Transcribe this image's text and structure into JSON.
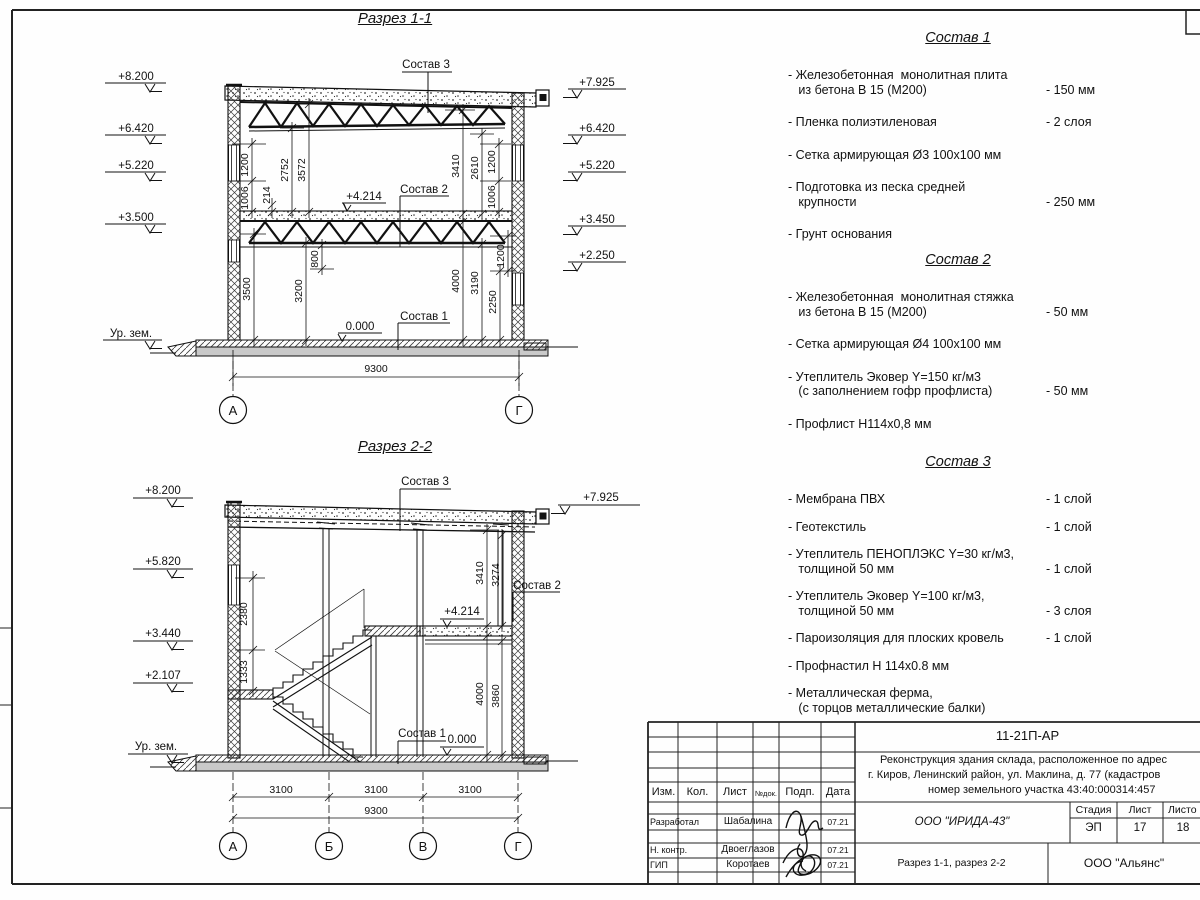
{
  "r1": {
    "title": "Разрез 1-1",
    "elev": {
      "l1": "+8.200",
      "l2": "+6.420",
      "l3": "+5.220",
      "l4": "+3.500",
      "ground": "Ур. зем.",
      "r1": "+7.925",
      "r2": "+6.420",
      "r3": "+5.220",
      "r4": "+3.450",
      "r5": "+2.250",
      "mid": "+4.214",
      "zero": "0.000"
    },
    "dims": {
      "d1200l": "1200",
      "d1006l": "1006",
      "d214": "214",
      "d2752": "2752",
      "d3572": "3572",
      "d3410": "3410",
      "d2610": "2610",
      "d1200r": "1200",
      "d1006r": "1006",
      "d3500": "3500",
      "d3200": "3200",
      "d800": "800",
      "d4000": "4000",
      "d3190": "3190",
      "d2250": "2250",
      "d1200r2": "1200",
      "span": "9300"
    },
    "labels": {
      "s1": "Состав 1",
      "s2": "Состав 2",
      "s3": "Состав 3"
    },
    "axes": {
      "a": "А",
      "g": "Г"
    }
  },
  "r2": {
    "title": "Разрез 2-2",
    "elev": {
      "l1": "+8.200",
      "l2": "+5.820",
      "l3": "+3.440",
      "l4": "+2.107",
      "ground": "Ур. зем.",
      "r1": "+7.925",
      "mid": "+4.214",
      "zero": "0.000"
    },
    "dims": {
      "d2380": "2380",
      "d1333": "1333",
      "d3410": "3410",
      "d3274": "3274",
      "d4000": "4000",
      "d3860": "3860",
      "s1": "3100",
      "s2": "3100",
      "s3": "3100",
      "span": "9300"
    },
    "labels": {
      "s1": "Состав 1",
      "s2": "Состав 2",
      "s3": "Состав 3"
    },
    "axes": {
      "a": "А",
      "b": "Б",
      "v": "В",
      "g": "Г"
    }
  },
  "sostav1": {
    "title": "Состав 1",
    "items": [
      {
        "name": "- Железобетонная  монолитная плита\n   из бетона В 15 (М200)",
        "value": "- 150 мм"
      },
      {
        "name": "- Пленка полиэтиленовая",
        "value": "-  2 слоя"
      },
      {
        "name": "- Сетка армирующая Ø3 100х100 мм",
        "value": ""
      },
      {
        "name": "- Подготовка из песка средней\n   крупности",
        "value": "- 250 мм"
      },
      {
        "name": "- Грунт основания",
        "value": ""
      }
    ]
  },
  "sostav2": {
    "title": "Состав 2",
    "items": [
      {
        "name": "- Железобетонная  монолитная стяжка\n   из бетона В 15 (М200)",
        "value": "- 50 мм"
      },
      {
        "name": "- Сетка армирующая Ø4 100х100 мм",
        "value": ""
      },
      {
        "name": "- Утеплитель Эковер Y=150 кг/м3\n   (с заполнением гофр профлиста)",
        "value": "- 50 мм"
      },
      {
        "name": "- Профлист Н114х0,8 мм",
        "value": ""
      }
    ]
  },
  "sostav3": {
    "title": "Состав 3",
    "items": [
      {
        "name": "- Мембрана ПВХ",
        "value": "- 1 слой"
      },
      {
        "name": "- Геотекстиль",
        "value": "- 1 слой"
      },
      {
        "name": "- Утеплитель ПЕНОПЛЭКС Y=30 кг/м3,\n   толщиной 50 мм",
        "value": "- 1 слой"
      },
      {
        "name": "- Утеплитель Эковер Y=100 кг/м3,\n   толщиной 50 мм",
        "value": "- 3 слоя"
      },
      {
        "name": "- Пароизоляция для плоских кровель",
        "value": "- 1 слой"
      },
      {
        "name": "- Профнастил Н 114х0.8 мм",
        "value": ""
      },
      {
        "name": "- Металлическая ферма,\n   (с торцов металлические балки)",
        "value": ""
      }
    ]
  },
  "stamp": {
    "code": "11-21П-АР",
    "project_line1": "Реконструкция здания склада, расположенное по адрес",
    "project_line2": "г. Киров, Ленинский район, ул. Маклина, д. 77 (кадастров",
    "project_line3": "номер земельного участка 43:40:000314:457",
    "cols": {
      "izm": "Изм.",
      "kol": "Кол.",
      "list": "Лист",
      "ndok": "№док.",
      "podp": "Подп.",
      "data": "Дата"
    },
    "rows": [
      {
        "role": "Разработал",
        "name": "Шабалина",
        "date": "07.21"
      },
      {
        "role": "Н. контр.",
        "name": "Двоеглазов",
        "date": "07.21"
      },
      {
        "role": "ГИП",
        "name": "Коротаев",
        "date": "07.21"
      }
    ],
    "org": "ООО \"ИРИДА-43\"",
    "stage_label": "Стадия",
    "sheet_label": "Лист",
    "sheets_label": "Листо",
    "stage": "ЭП",
    "sheet_no": "17",
    "sheets_total": "18",
    "doc_title": "Разрез 1-1, разрез 2-2",
    "contractor": "ООО \"Альянс\""
  }
}
